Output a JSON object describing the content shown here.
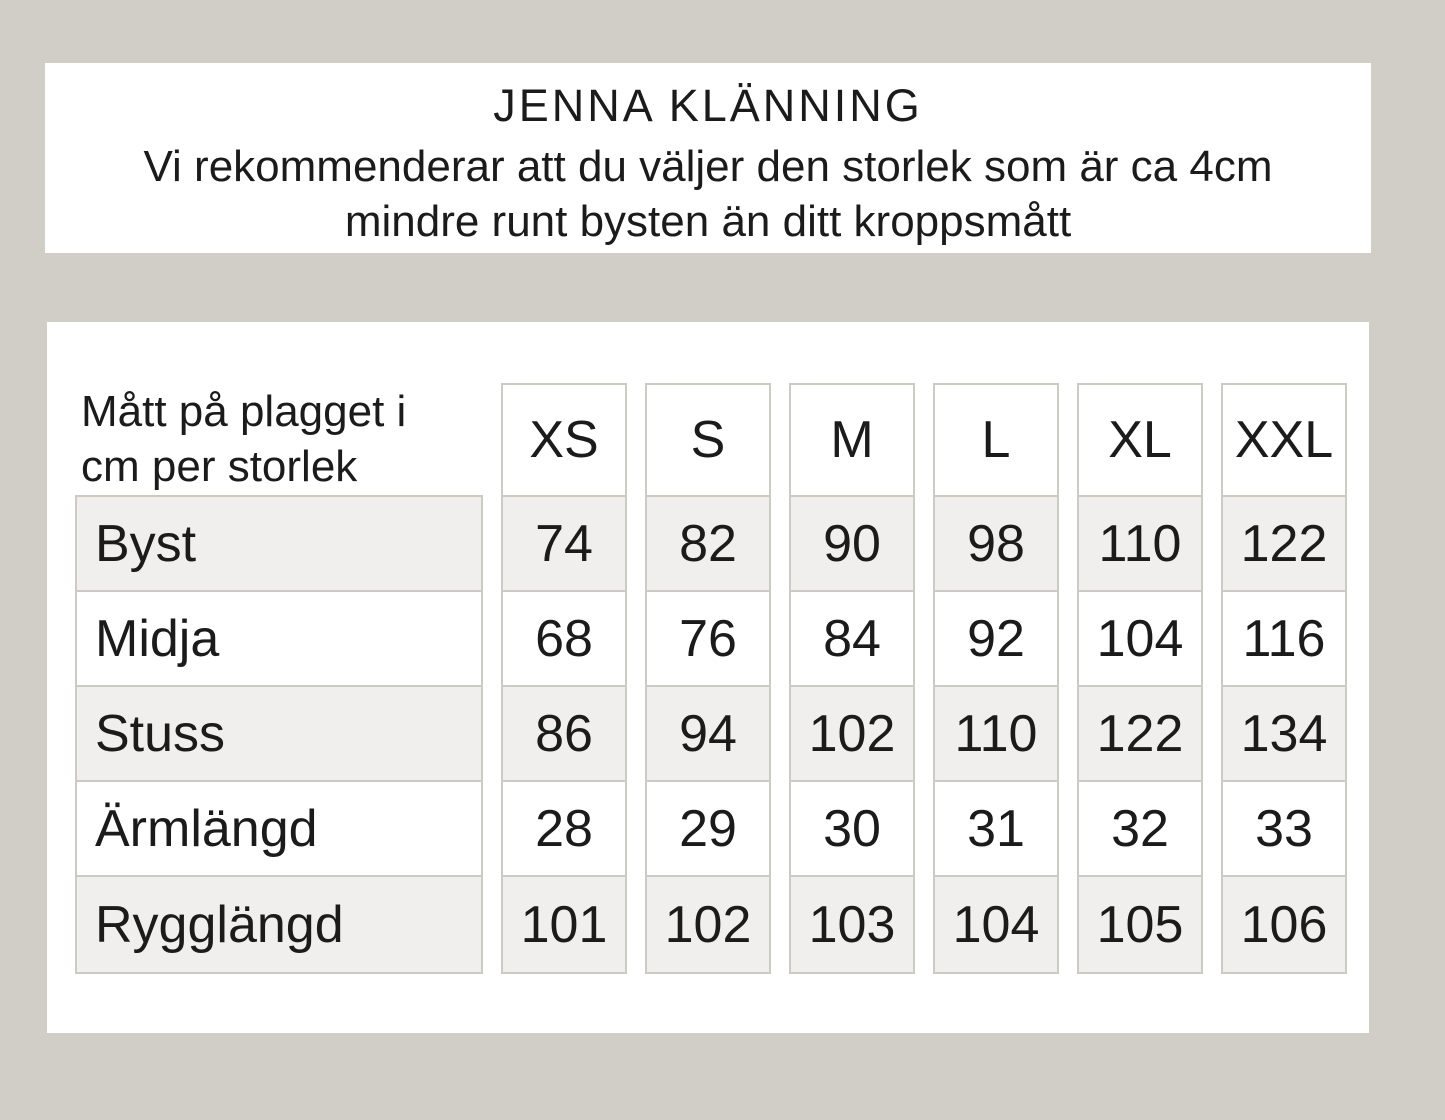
{
  "colors": {
    "page_background": "#d1cec7",
    "panel_background": "#ffffff",
    "row_shade": "#f0efed",
    "cell_border": "#cdcac3",
    "text": "#1b1b1b"
  },
  "chart_data": {
    "type": "table",
    "title": "JENNA KLÄNNING",
    "subtitle_lines": [
      "Vi rekommenderar att du väljer den storlek som är ca 4cm",
      "mindre runt bysten än ditt kroppsmått"
    ],
    "corner_label_lines": [
      "Mått på plagget i",
      "cm per storlek"
    ],
    "columns": [
      "XS",
      "S",
      "M",
      "L",
      "XL",
      "XXL"
    ],
    "rows": [
      {
        "label": "Byst",
        "values": [
          "74",
          "82",
          "90",
          "98",
          "110",
          "122"
        ]
      },
      {
        "label": "Midja",
        "values": [
          "68",
          "76",
          "84",
          "92",
          "104",
          "116"
        ]
      },
      {
        "label": "Stuss",
        "values": [
          "86",
          "94",
          "102",
          "110",
          "122",
          "134"
        ]
      },
      {
        "label": "Ärmlängd",
        "values": [
          "28",
          "29",
          "30",
          "31",
          "32",
          "33"
        ]
      },
      {
        "label": "Rygglängd",
        "values": [
          "101",
          "102",
          "103",
          "104",
          "105",
          "106"
        ]
      }
    ]
  }
}
